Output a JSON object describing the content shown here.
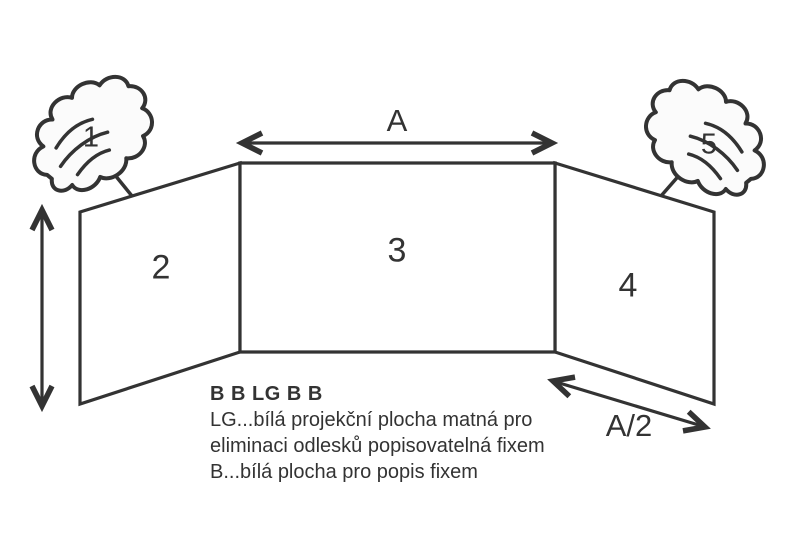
{
  "labels": {
    "dim_width": "A",
    "dim_half_width": "A/2",
    "handle_left": "1",
    "handle_right": "5",
    "panel_left": "2",
    "panel_center": "3",
    "panel_right": "4"
  },
  "legend": {
    "title": "B B LG B B",
    "lines": [
      "LG...bílá projekční plocha matná pro",
      "eliminaci odlesků popisovatelná fixem",
      "B...bílá plocha pro popis fixem"
    ]
  },
  "colors": {
    "line": "#333333",
    "text": "#333333",
    "glove_fill": "#fbfbfb",
    "background": "#ffffff"
  }
}
